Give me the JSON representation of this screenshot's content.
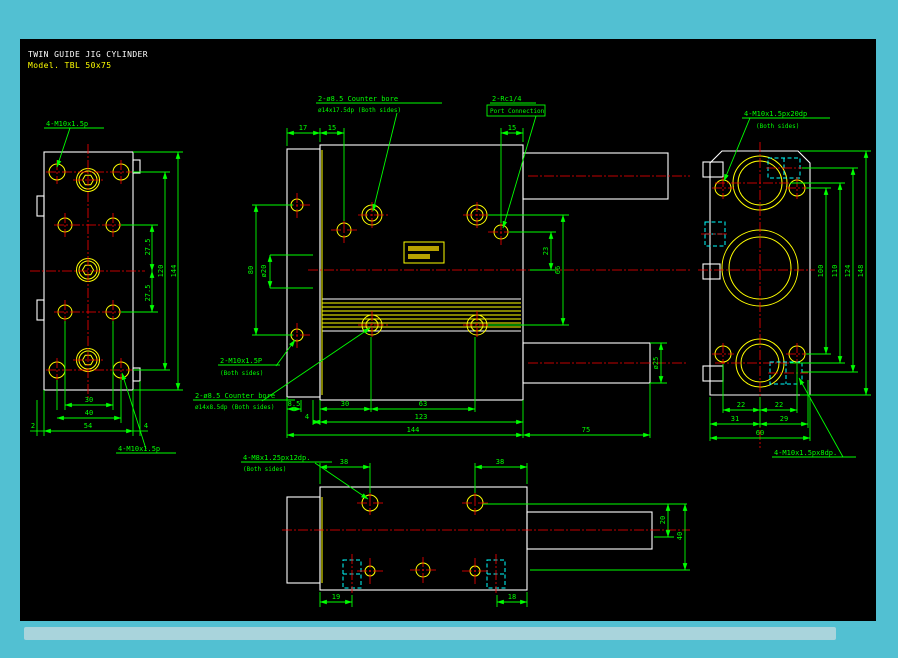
{
  "title": {
    "line1": "TWIN GUIDE JIG CYLINDER",
    "line2": "Model. TBL 50x75"
  },
  "colors": {
    "background": "#52c0d2",
    "canvas": "#000000",
    "outline": "#ffffff",
    "detail": "#ffff00",
    "dimension": "#00ff00",
    "centerline": "#ff0000",
    "hidden": "#00ffff",
    "scrollbar": "#a9d4dc"
  },
  "left_view": {
    "top_label": "4-M10x1.5p",
    "bottom_label": "4-M10x1.5p",
    "dims": {
      "h27a": "27.5",
      "h27b": "27.5",
      "h120": "120",
      "h144": "144",
      "w30": "30",
      "w40": "40",
      "w54": "54",
      "w2": "2",
      "w4": "4"
    }
  },
  "front_view": {
    "counterbore_top_label": {
      "line1": "2-ø8.5 Counter bore",
      "line2": "ø14x17.5dp (Both sides)"
    },
    "port_label": {
      "line1": "2-Rc1/4",
      "line2": "Port Connection"
    },
    "thread_label": {
      "line1": "2-M10x1.5P",
      "line2": "(Both sides)"
    },
    "counterbore_bottom_label": {
      "line1": "2-ø8.5 Counter bore",
      "line2": "ø14x8.5dp (Both sides)"
    },
    "dims": {
      "w17": "17",
      "w15_left": "15",
      "w15_right": "15",
      "h80": "80",
      "dia20": "ø20",
      "h23": "23",
      "h66": "66",
      "w8_5": "8.5",
      "w30": "30",
      "w63": "63",
      "w4": "4",
      "w123": "123",
      "w144": "144",
      "w75": "75",
      "dia25": "ø25"
    }
  },
  "right_view": {
    "top_label": {
      "line1": "4-M10x1.5px20dp",
      "line2": "(Both sides)"
    },
    "bottom_label": "4-M10x1.5px8dp.",
    "dims": {
      "h100": "100",
      "h110": "110",
      "h124": "124",
      "h148": "148",
      "w22a": "22",
      "w22b": "22",
      "w31": "31",
      "w29": "29",
      "w60": "60"
    }
  },
  "bottom_view": {
    "thread_label": {
      "line1": "4-M8x1.25px12dp.",
      "line2": "(Both sides)"
    },
    "dims": {
      "w38a": "38",
      "w38b": "38",
      "w19": "19",
      "w18": "18",
      "h20": "20",
      "h40": "40"
    }
  }
}
